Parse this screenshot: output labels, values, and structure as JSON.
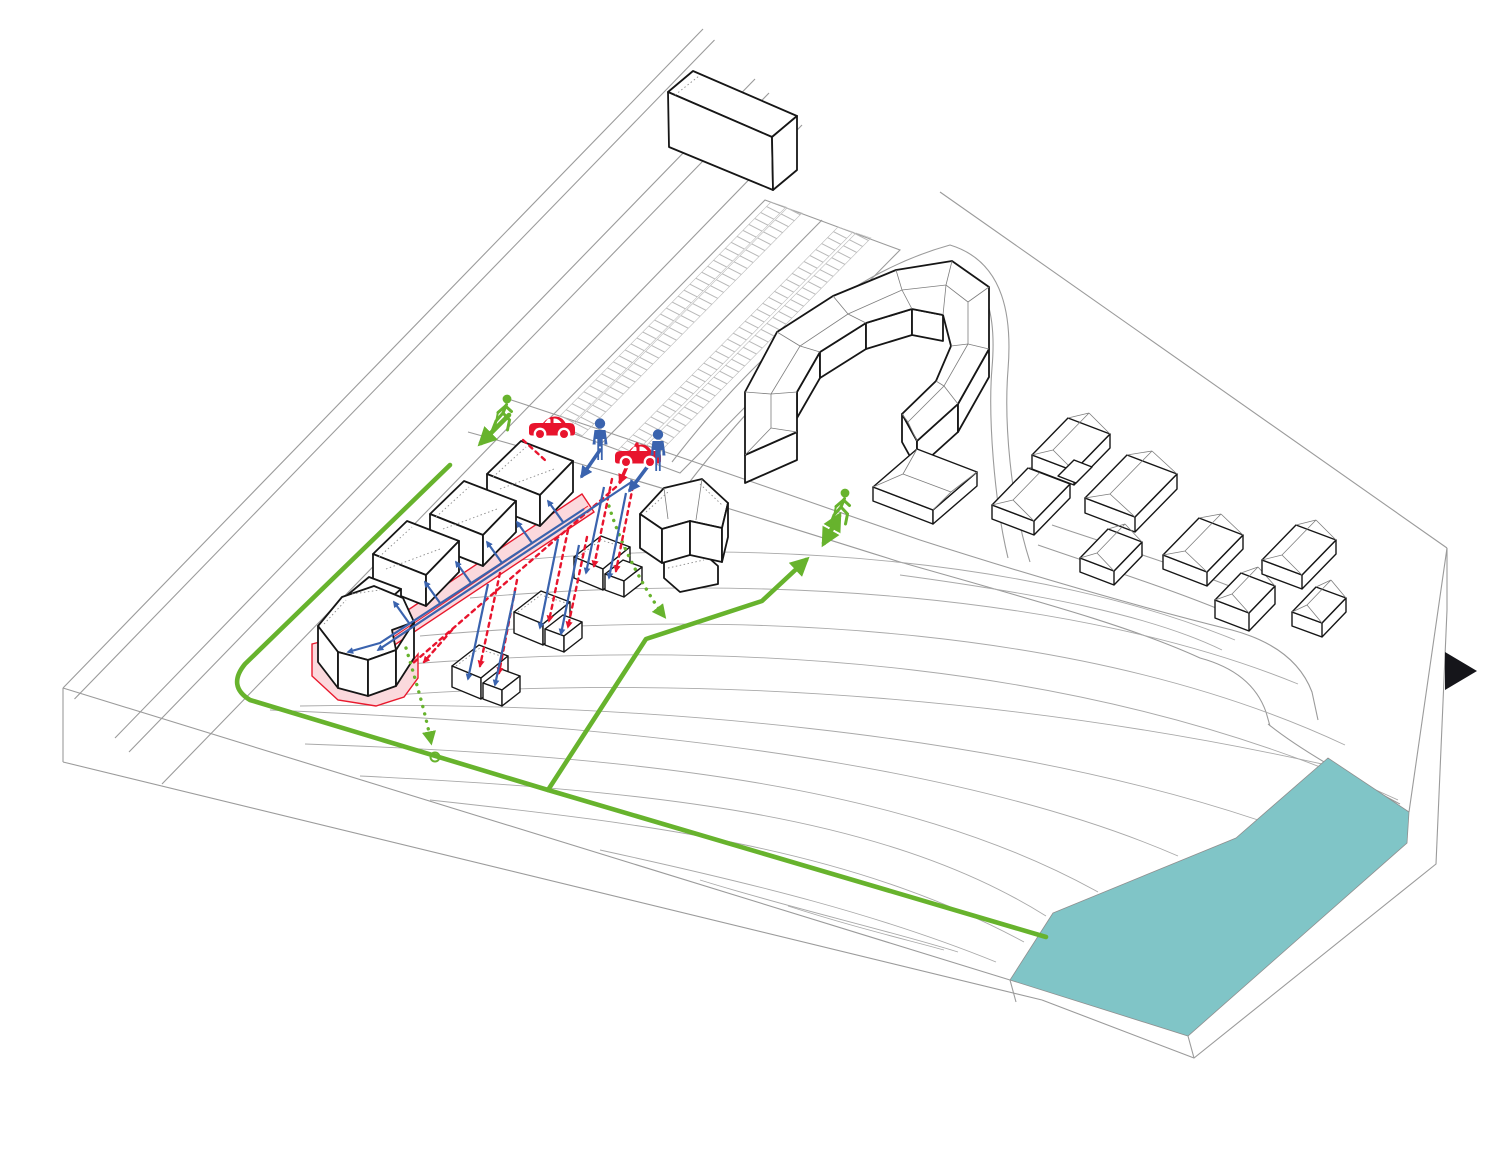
{
  "page": {
    "background": "#ffffff"
  },
  "colors": {
    "background": "#ffffff",
    "line_gray": "#9b9b9b",
    "contour_gray": "#a9a9a9",
    "building_stroke": "#161616",
    "route_green": "#67b32d",
    "route_blue": "#3a63ae",
    "route_red": "#e8142d",
    "street_pink_fill": "#fbd9dd",
    "street_pink_stroke": "#e8192d",
    "water_teal": "#80c5c7",
    "icon_black": "#15151a"
  },
  "icons": {
    "pedestrian_walking": {
      "glyph": "🚶",
      "color_key": "route_green",
      "count": 2
    },
    "person_standing": {
      "glyph": "🧍",
      "color_key": "route_blue",
      "count": 2
    },
    "car": {
      "glyph": "🚗",
      "color_key": "route_red",
      "count": 2
    },
    "next_arrow": {
      "glyph": "▶",
      "color_key": "icon_black",
      "count": 1
    }
  },
  "layers": [
    "roads-and-parking",
    "terrain-contours",
    "water-body",
    "pink-shared-street",
    "buildings",
    "green-pedestrian-paths",
    "red-vehicle-routes",
    "blue-pedestrian-routes",
    "crossing-icons",
    "next-slide-button"
  ]
}
